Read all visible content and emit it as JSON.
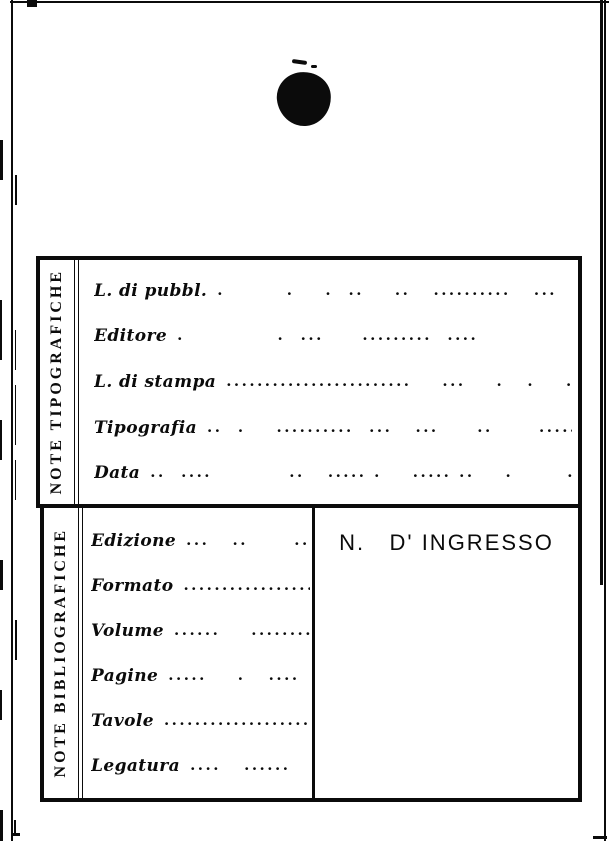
{
  "page": {
    "paper_color": "#ffffff",
    "ink_color": "#0b0b0b"
  },
  "note_tipografiche": {
    "side_label": "NOTE TIPOGRAFICHE",
    "rows": [
      {
        "label": "L. di pubbl.",
        "dots": ".        .    .  ..    ..   ..........   ...     ..   ..   ......."
      },
      {
        "label": "Editore",
        "dots": ".            .  ...     .........  ....               ..   ....."
      },
      {
        "label": "L. di stampa",
        "dots": "........................    ...    .   .    .........."
      },
      {
        "label": "Tipografia",
        "dots": "..  .    ..........  ...   ...     ..      ............."
      },
      {
        "label": "Data",
        "dots": "..  ....          ..   ..... .    ..... ..    .       .      ....."
      }
    ]
  },
  "note_bibliografiche": {
    "side_label": "NOTE BIBLIOGRAFICHE",
    "rows": [
      {
        "label": "Edizione",
        "dots": "...   ..      ..  ...."
      },
      {
        "label": "Formato",
        "dots": "......................"
      },
      {
        "label": "Volume",
        "dots": "......    ............"
      },
      {
        "label": "Pagine",
        "dots": ".....    .   ....  .  ..."
      },
      {
        "label": "Tavole",
        "dots": "....................."
      },
      {
        "label": "Legatura",
        "dots": "....   ......     ."
      }
    ],
    "ingresso_label": "N.   D' INGRESSO"
  }
}
